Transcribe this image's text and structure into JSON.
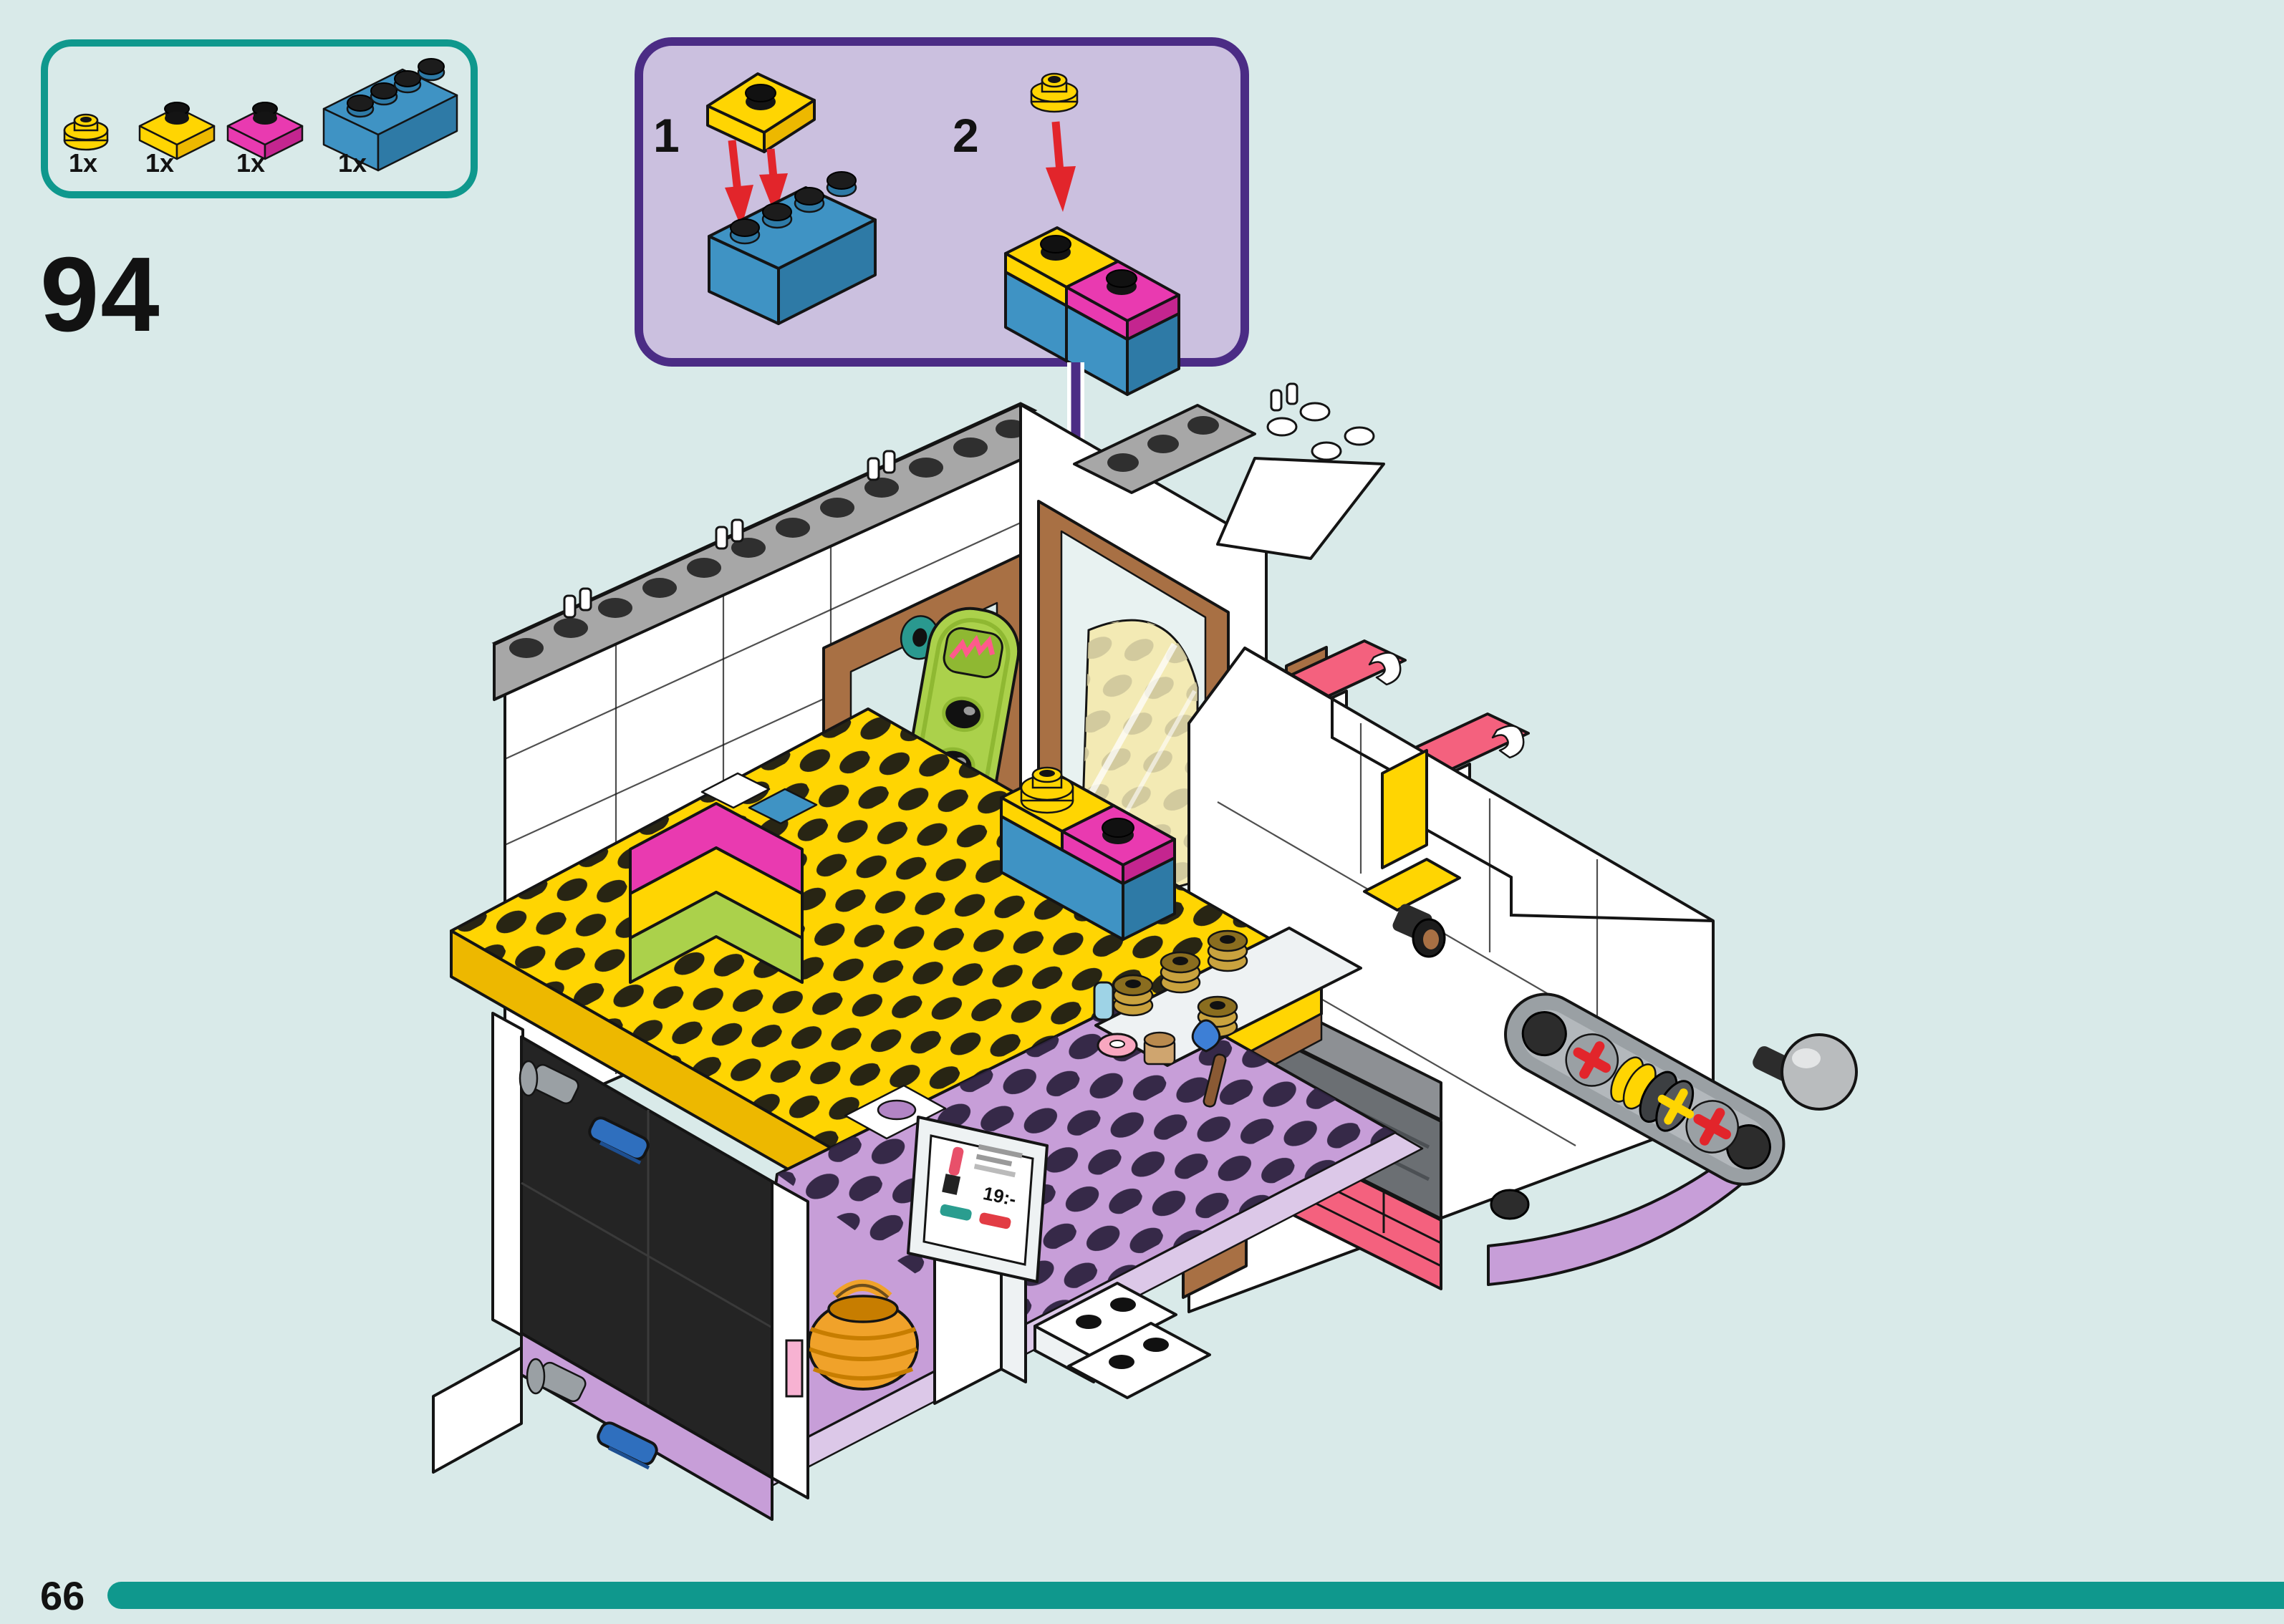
{
  "page": {
    "step_number": "94",
    "page_number": "66"
  },
  "parts_panel": {
    "parts": [
      {
        "name": "plate-round-1x1-yellow",
        "qty": "1x"
      },
      {
        "name": "plate-1x2-yellow",
        "qty": "1x"
      },
      {
        "name": "plate-1x2-magenta",
        "qty": "1x"
      },
      {
        "name": "brick-1x4-blue",
        "qty": "1x"
      }
    ]
  },
  "callout": {
    "steps": [
      {
        "num": "1"
      },
      {
        "num": "2"
      }
    ]
  },
  "model": {
    "kiosk_price": "19:-"
  },
  "palette": {
    "bg": "#d9eae9",
    "teal": "#0f988d",
    "purple": "#4b2c85",
    "callout_fill": "#cbc0df",
    "red": "#e2252b",
    "yellow": "#ffd502",
    "yellow_dark": "#edb800",
    "blue": "#3f93c4",
    "blue_dark": "#2e7aa6",
    "magenta": "#e93ab0",
    "magenta_dark": "#c4258f",
    "pink": "#f4617e",
    "pink_dark": "#e04a68",
    "lime": "#abd14b",
    "lime_dark": "#8fb832",
    "teal_wheel": "#2a998f",
    "brown": "#a87044",
    "brown_dark": "#8a5a34",
    "tan": "#cfa56f",
    "gold": "#c9a23e",
    "lavender": "#c79ed8",
    "lavender_light": "#dcc8e8",
    "lavender_dark": "#b285c5",
    "gray_cap": "#a7a7a7",
    "gray_mid": "#8d9094",
    "gray_tech": "#9aa0a4",
    "gray_dark": "#6b6f73",
    "near_black": "#242424",
    "white": "#ffffff",
    "off_white": "#eef2f3",
    "outline": "#141414",
    "glass": "#e8f2f1",
    "trans_yellow": "#f3eab4",
    "screen_teal": "#2a9d8f",
    "screen_red": "#e23c44",
    "basket": "#f0a22a"
  }
}
